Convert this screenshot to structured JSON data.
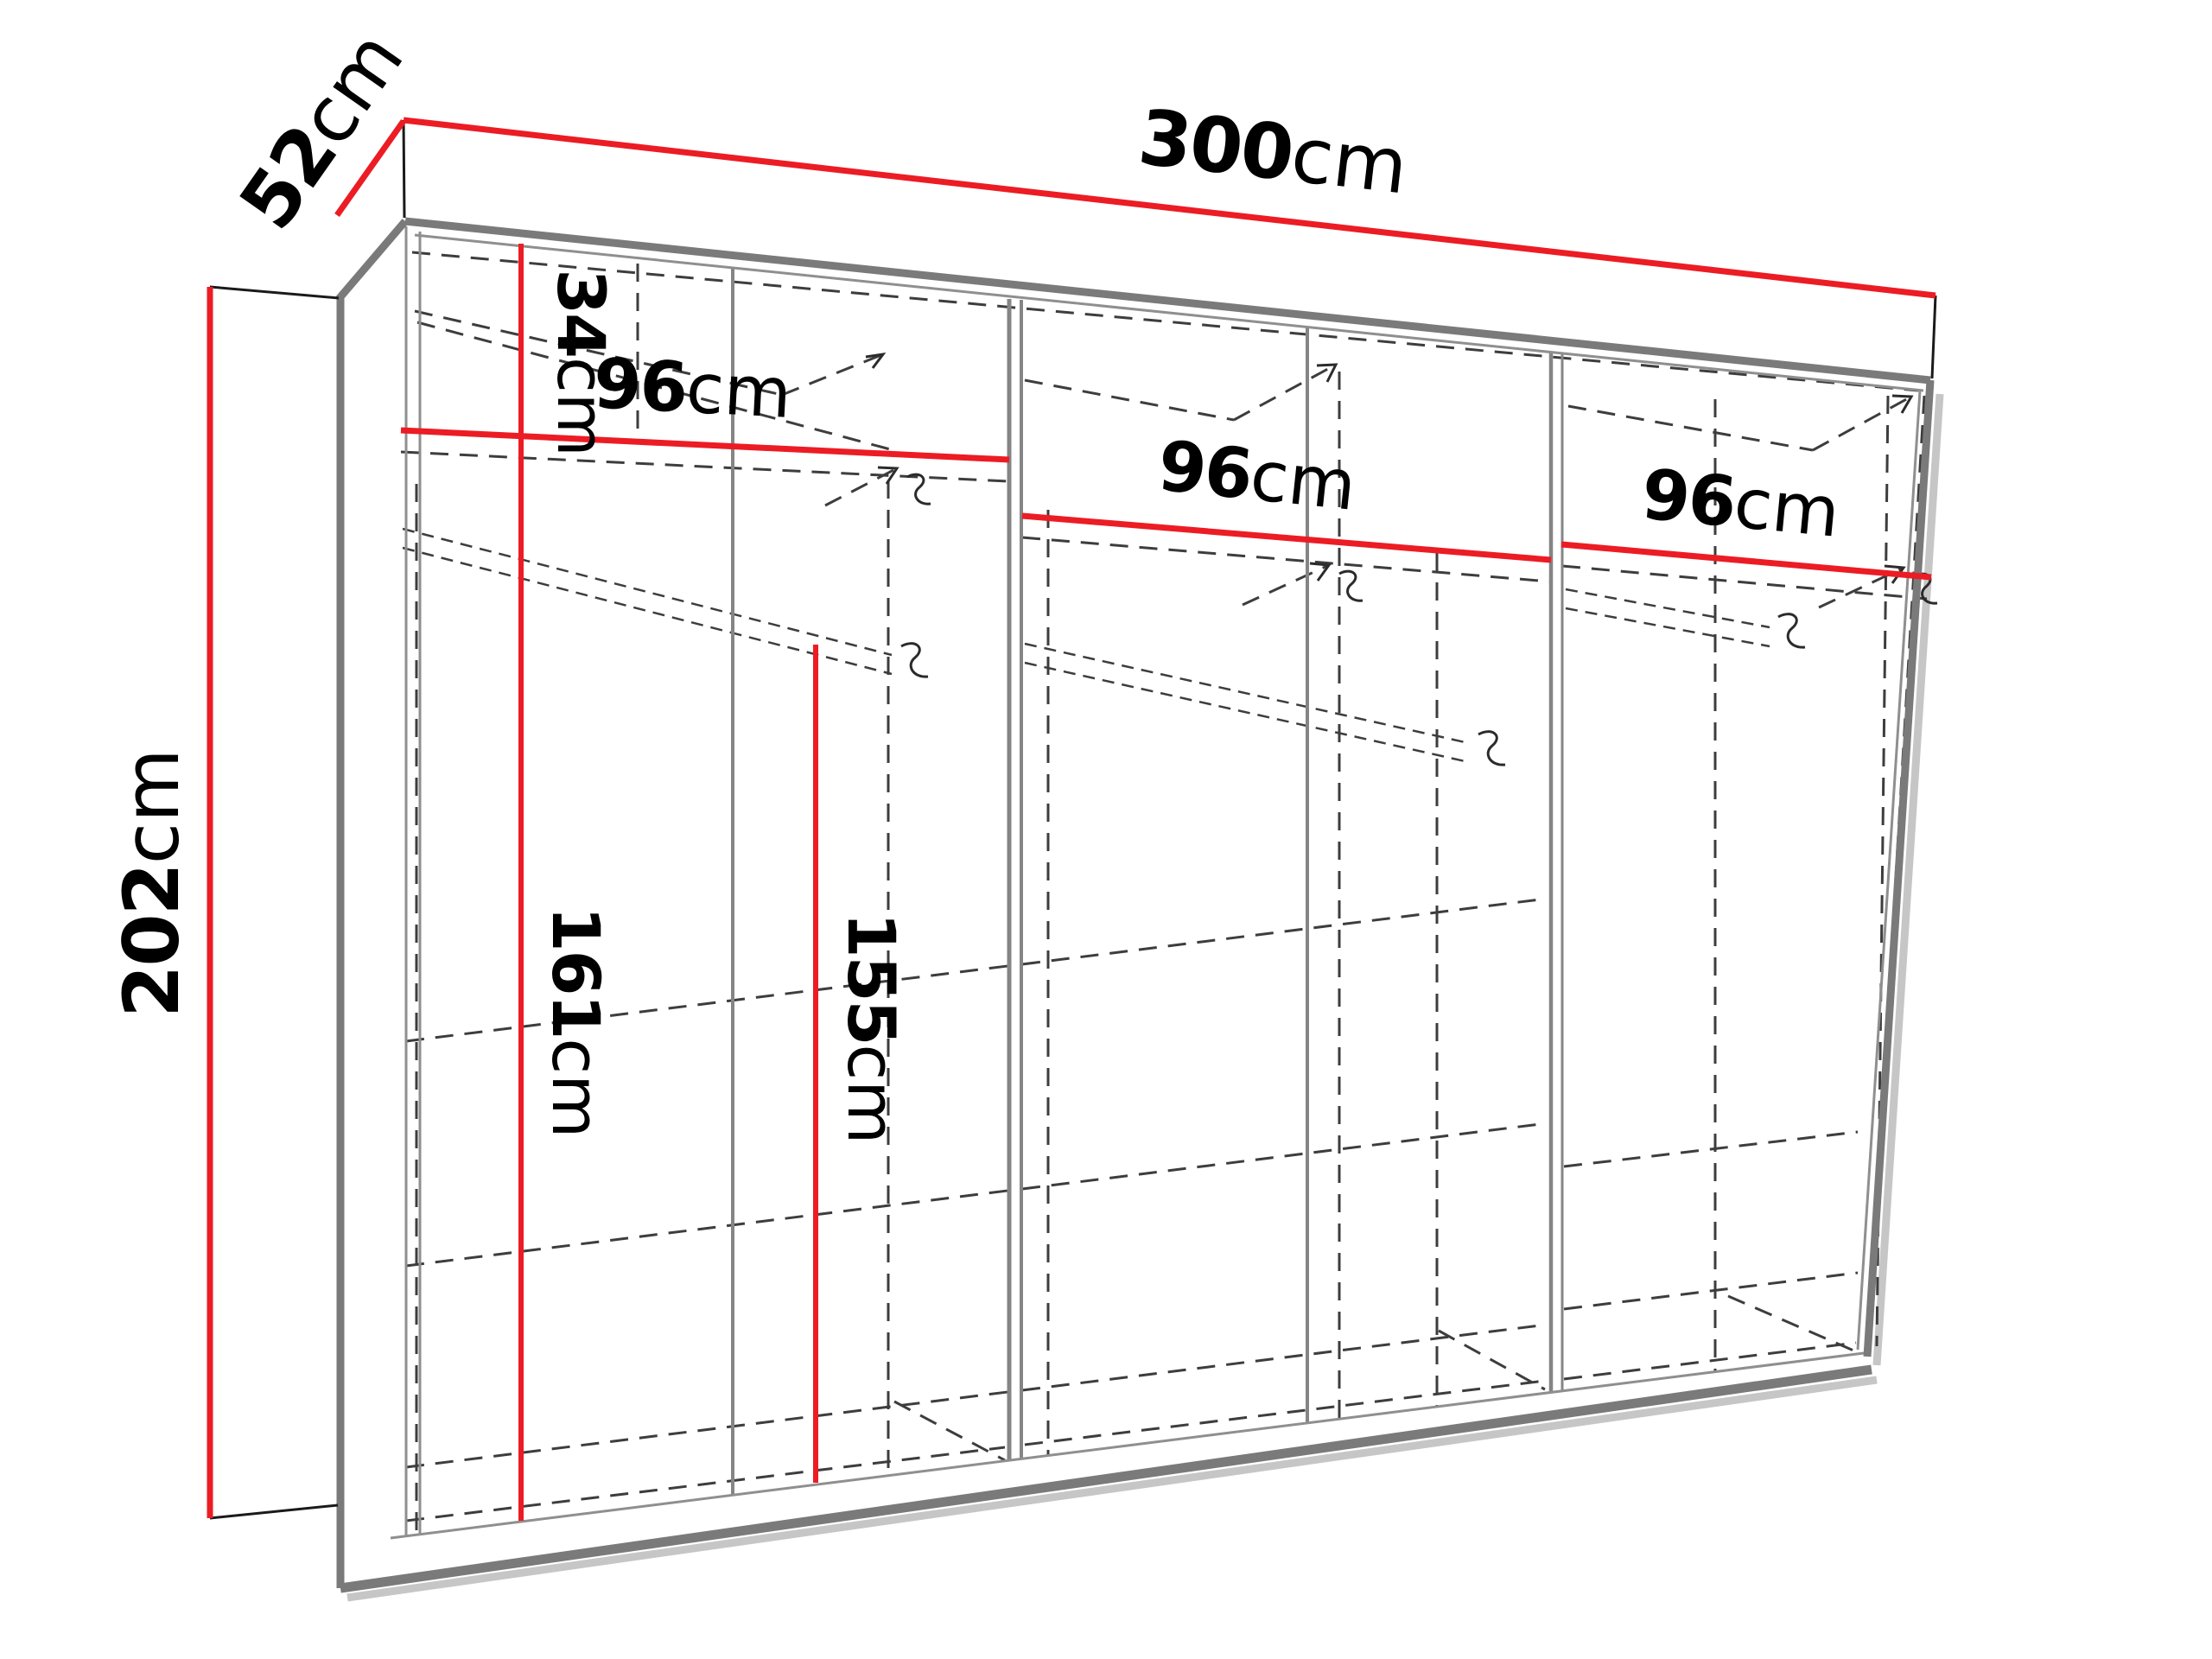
{
  "diagram": {
    "name": "wardrobe-dimensions-diagram",
    "dimension_labels": {
      "width": {
        "value": "300",
        "unit": "cm"
      },
      "depth": {
        "value": "52",
        "unit": "cm"
      },
      "height": {
        "value": "202",
        "unit": "cm"
      },
      "top_compartment_height": {
        "value": "34",
        "unit": "cm"
      },
      "section_1_width": {
        "value": "96",
        "unit": "cm"
      },
      "section_2_width": {
        "value": "96",
        "unit": "cm"
      },
      "section_3_width": {
        "value": "96",
        "unit": "cm"
      },
      "left_compartment_height": {
        "value": "161",
        "unit": "cm"
      },
      "rail_compartment_height": {
        "value": "155",
        "unit": "cm"
      }
    },
    "colors": {
      "dimension_line": "#ec1c24",
      "frame_edge": "#7a7a7a",
      "hidden_edge": "#3d3d3d",
      "background": "#ffffff"
    }
  }
}
